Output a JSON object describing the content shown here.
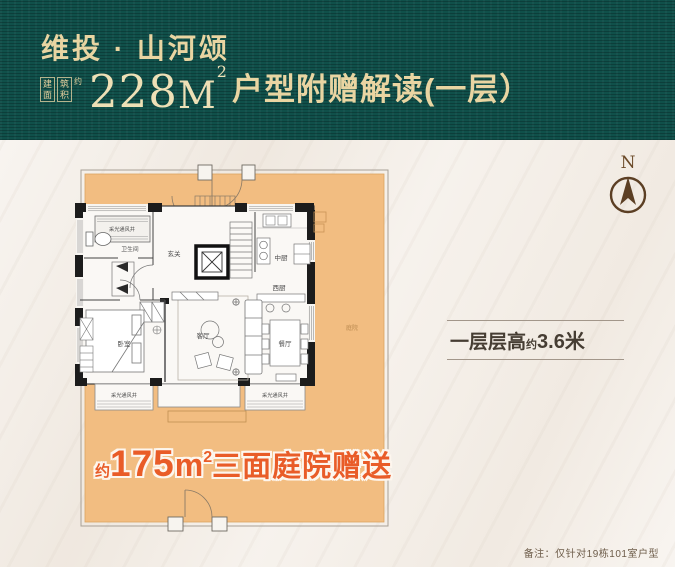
{
  "header": {
    "brand": "维投 · 山河颂",
    "area_block": {
      "col1": "建面",
      "col2": "筑积",
      "approx": "约"
    },
    "area_value": "228",
    "area_unit": "M",
    "area_sup": "2",
    "subtitle": "户型附赠解读(一层）"
  },
  "compass": {
    "label": "N"
  },
  "floorplan": {
    "labels": {
      "lightwell": "采光通风井",
      "bathroom": "卫生间",
      "foyer": "玄关",
      "kitchen_cn": "中厨",
      "kitchen_west": "西厨",
      "living": "客厅",
      "bedroom": "卧室",
      "dining": "餐厅",
      "courtyard": "庭院"
    },
    "promo": {
      "approx": "约",
      "value": "175",
      "unit": "m",
      "sup": "2",
      "text": "三面庭院赠送"
    }
  },
  "floor_height": {
    "prefix": "一层层高",
    "approx": "约",
    "value": "3.6米"
  },
  "note": "备注：仅针对19栋101室户型",
  "colors": {
    "header_bg": "#10504a",
    "header_gold": "#e9d5a2",
    "page_bg": "#f4eee7",
    "courtyard_orange": "#f2bd81",
    "promo_orange": "#e95c28",
    "compass_brown": "#5c3f24",
    "wall_black": "#1c1c1c"
  }
}
